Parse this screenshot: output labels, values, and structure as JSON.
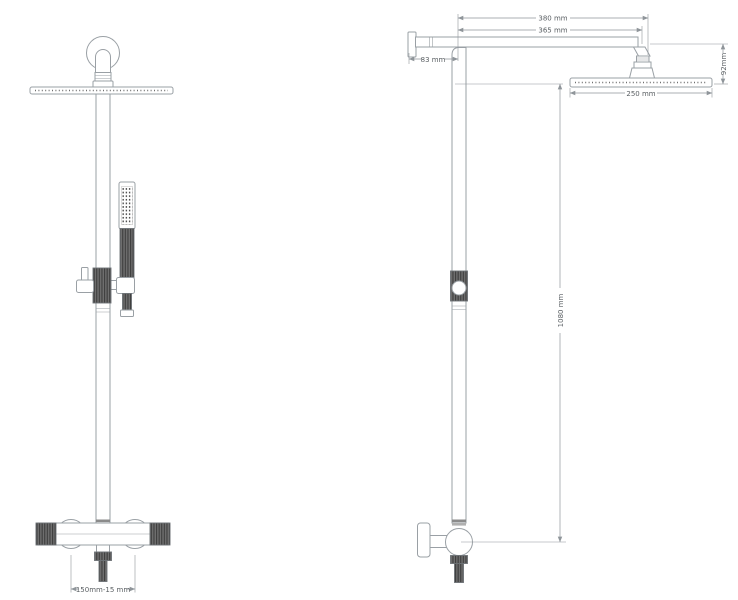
{
  "drawing": {
    "type": "technical-dimension-diagram",
    "subject": "shower column, front and side elevation",
    "colors": {
      "background": "#ffffff",
      "outline": "#9aa0a5",
      "dimension_lines": "#8f959a",
      "dimension_text": "#5a5f63",
      "dark_knurl": "#4d4d4d"
    },
    "dimensions": {
      "arm_overall": "380 mm",
      "arm_to_head": "365 mm",
      "wall_offset": "83 mm",
      "head_drop": "92mm",
      "head_width": "250 mm",
      "riser_height": "1080 mm",
      "valve_centres": "150mm-15 mm"
    }
  }
}
